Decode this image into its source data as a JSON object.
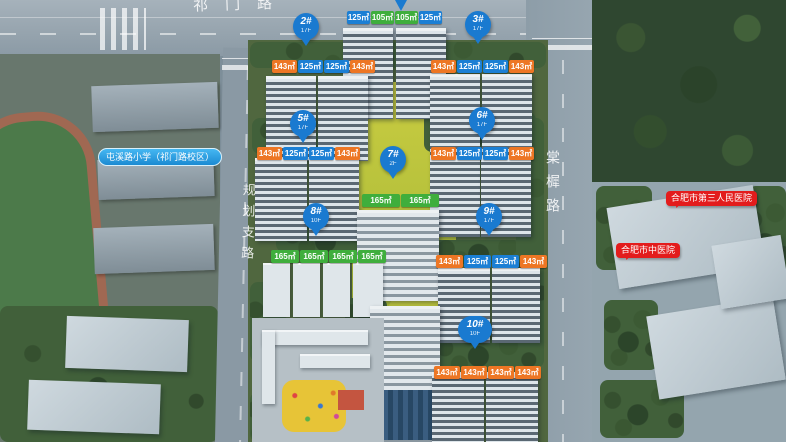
{
  "map": {
    "roads": {
      "top": "祁门路",
      "left": "规划支路",
      "right": "棠樨路"
    },
    "pois": {
      "school": {
        "text": "屯溪路小学（祁门路校区）"
      },
      "hospital_third": {
        "text": "合肥市第三人民医院"
      },
      "hospital_tcm": {
        "text": "合肥市中医院"
      }
    },
    "colors": {
      "tag_orange": "#ed7624",
      "tag_blue": "#1b7fd4",
      "tag_green": "#3fae3c",
      "pin_blue": "#1a7ad0",
      "poi_pill_blue": "#29a3e3",
      "poi_bubble_red": "#e31c1c"
    },
    "clusters": [
      {
        "id": "north",
        "pin": null,
        "tags": [
          {
            "value": "125㎡",
            "color": "blue"
          },
          {
            "value": "105㎡",
            "color": "green"
          },
          {
            "value": "105㎡",
            "color": "green"
          },
          {
            "value": "125㎡",
            "color": "blue"
          }
        ]
      },
      {
        "id": "b2",
        "pin": {
          "num": "2#",
          "floor": "17F"
        },
        "tags": [
          {
            "value": "143㎡",
            "color": "orange"
          },
          {
            "value": "125㎡",
            "color": "blue"
          },
          {
            "value": "125㎡",
            "color": "blue"
          },
          {
            "value": "143㎡",
            "color": "orange"
          }
        ]
      },
      {
        "id": "b3",
        "pin": {
          "num": "3#",
          "floor": "17F"
        },
        "tags": [
          {
            "value": "143㎡",
            "color": "orange"
          },
          {
            "value": "125㎡",
            "color": "blue"
          },
          {
            "value": "125㎡",
            "color": "blue"
          },
          {
            "value": "143㎡",
            "color": "orange"
          }
        ]
      },
      {
        "id": "b5",
        "pin": {
          "num": "5#",
          "floor": "17F"
        },
        "tags": [
          {
            "value": "143㎡",
            "color": "orange"
          },
          {
            "value": "125㎡",
            "color": "blue"
          },
          {
            "value": "125㎡",
            "color": "blue"
          },
          {
            "value": "143㎡",
            "color": "orange"
          }
        ]
      },
      {
        "id": "b6",
        "pin": {
          "num": "6#",
          "floor": "17F"
        },
        "tags": [
          {
            "value": "143㎡",
            "color": "orange"
          },
          {
            "value": "125㎡",
            "color": "blue"
          },
          {
            "value": "125㎡",
            "color": "blue"
          },
          {
            "value": "143㎡",
            "color": "orange"
          }
        ]
      },
      {
        "id": "b7",
        "pin": {
          "num": "7#",
          "floor": "2F"
        },
        "tags": [
          {
            "value": "165㎡",
            "color": "green"
          },
          {
            "value": "165㎡",
            "color": "green"
          }
        ]
      },
      {
        "id": "b8",
        "pin": {
          "num": "8#",
          "floor": "10F"
        },
        "tags": [
          {
            "value": "165㎡",
            "color": "green"
          },
          {
            "value": "165㎡",
            "color": "green"
          },
          {
            "value": "165㎡",
            "color": "green"
          },
          {
            "value": "165㎡",
            "color": "green"
          }
        ]
      },
      {
        "id": "b9",
        "pin": {
          "num": "9#",
          "floor": "17F"
        },
        "tags": [
          {
            "value": "143㎡",
            "color": "orange"
          },
          {
            "value": "125㎡",
            "color": "blue"
          },
          {
            "value": "125㎡",
            "color": "blue"
          },
          {
            "value": "143㎡",
            "color": "orange"
          }
        ]
      },
      {
        "id": "b10",
        "pin": {
          "num": "10#",
          "floor": "10F"
        },
        "tags": [
          {
            "value": "143㎡",
            "color": "orange"
          },
          {
            "value": "143㎡",
            "color": "orange"
          },
          {
            "value": "143㎡",
            "color": "orange"
          },
          {
            "value": "143㎡",
            "color": "orange"
          }
        ]
      }
    ]
  }
}
